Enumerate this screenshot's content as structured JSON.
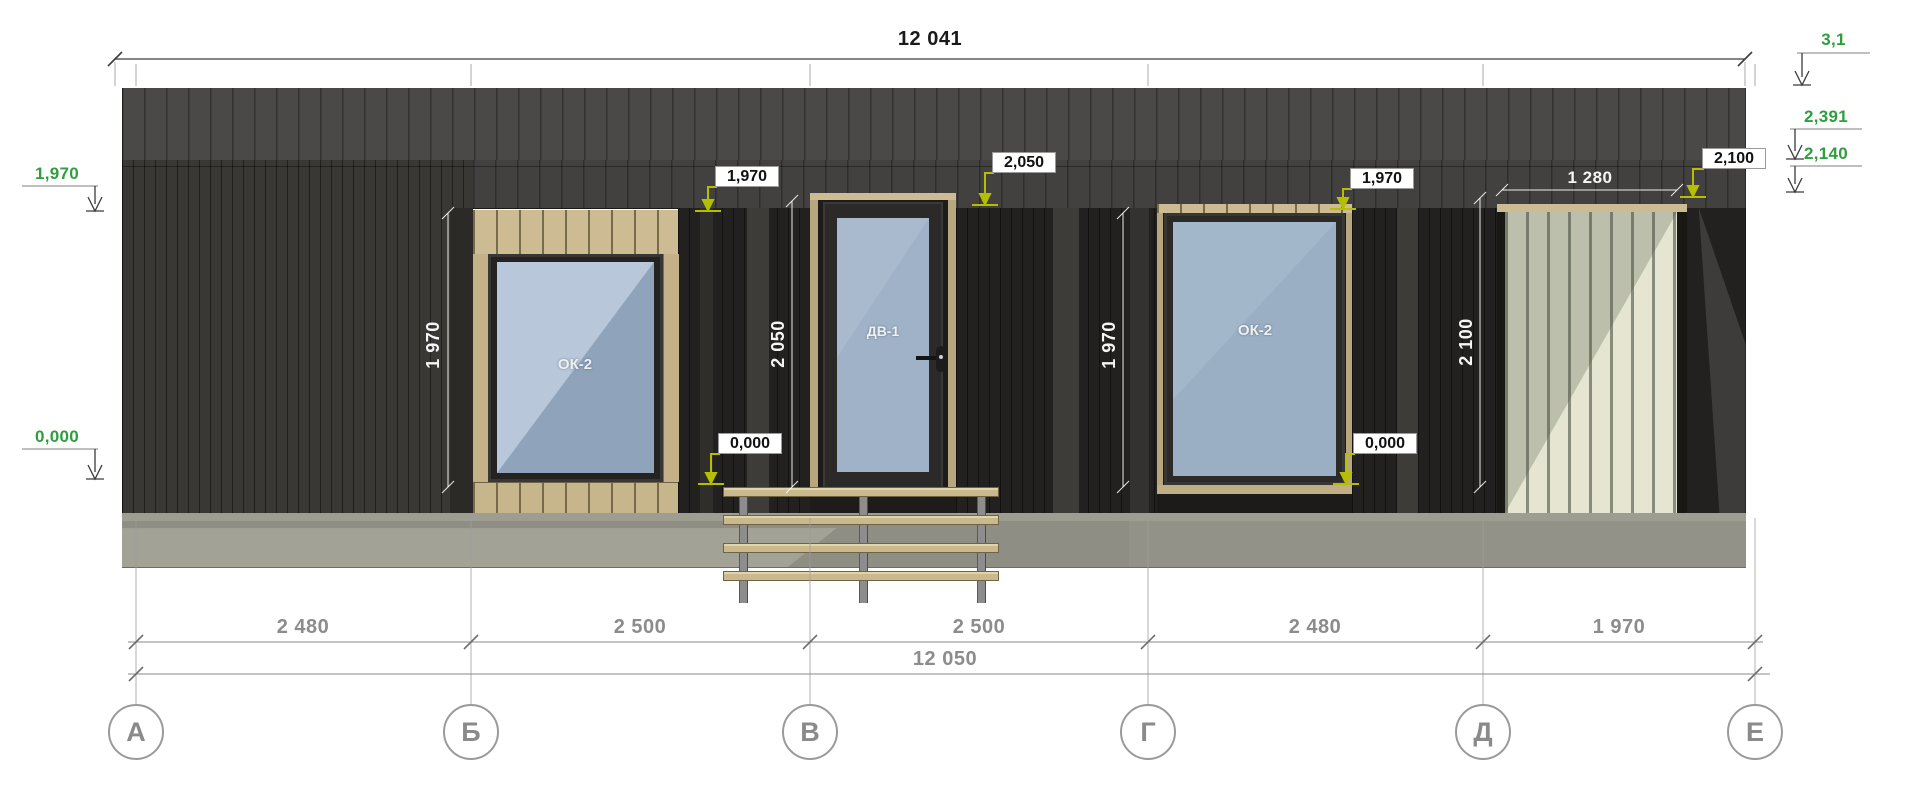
{
  "dimensions": {
    "top_total": "12 041",
    "bottom_total": "12 050",
    "spans": [
      "2 480",
      "2 500",
      "2 500",
      "2 480",
      "1 970"
    ],
    "panel_width": "1 280",
    "vertical": [
      "1 970",
      "2 050",
      "1 970",
      "2 100"
    ]
  },
  "levels": {
    "left": [
      "1,970",
      "0,000"
    ],
    "right": [
      "3,1",
      "2,391",
      "2,140"
    ],
    "callouts": [
      "1,970",
      "2,050",
      "1,970",
      "0,000",
      "0,000",
      "2,100"
    ]
  },
  "axes": [
    "А",
    "Б",
    "В",
    "Г",
    "Д",
    "Е"
  ],
  "openings": {
    "window1": "ОК-2",
    "door": "ДВ-1",
    "window2": "ОК-2"
  },
  "colors": {
    "elevation_green": "#2f9e3e",
    "leader_yellow": "#b3bf00",
    "trim_tan": "#cdbb93",
    "glass_blue": "#9bafc4",
    "facade_dark": "#22211f",
    "fascia": "#4b4947",
    "plinth_gray": "#8e8e84",
    "dim_gray": "#8c8c8c"
  }
}
